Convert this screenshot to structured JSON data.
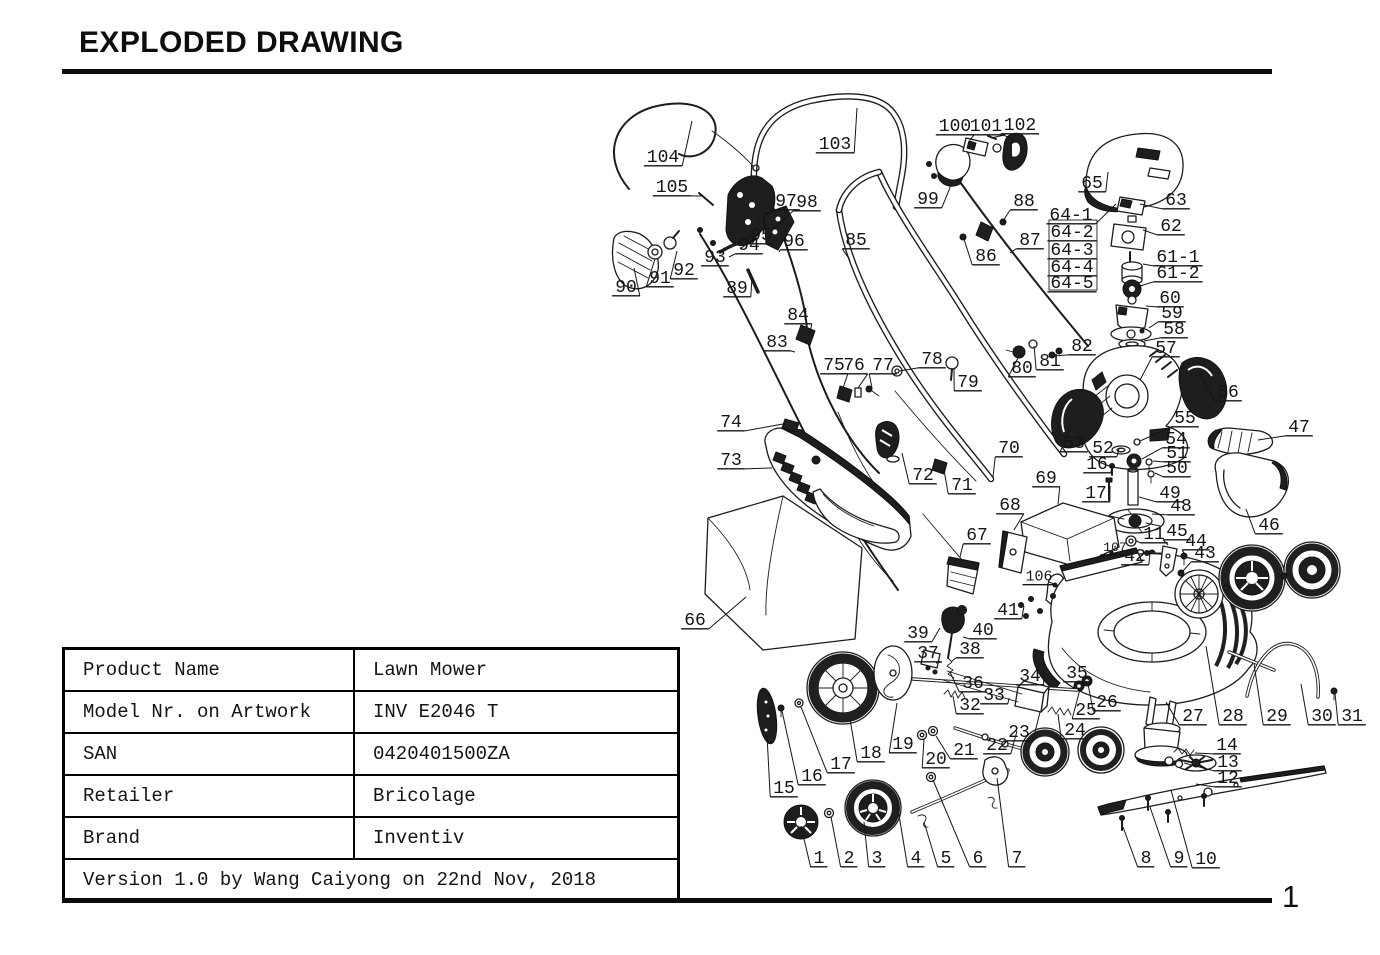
{
  "page": {
    "title": "EXPLODED DRAWING",
    "number": "1"
  },
  "info_table": {
    "rows": [
      {
        "label": "Product Name",
        "value": "Lawn Mower"
      },
      {
        "label": "Model Nr. on Artwork",
        "value": "INV E2046 T"
      },
      {
        "label": "SAN",
        "value": "0420401500ZA"
      },
      {
        "label": "Retailer",
        "value": "Bricolage"
      },
      {
        "label": "Brand",
        "value": "Inventiv"
      }
    ],
    "footer": "Version 1.0 by Wang Caiyong on 22nd Nov, 2018"
  },
  "drawing": {
    "description": "Exploded parts diagram of a lawn mower with numbered part callouts",
    "labels": [
      [
        "104",
        663,
        155,
        692,
        121
      ],
      [
        "105",
        672,
        185,
        703,
        196
      ],
      [
        "103",
        835,
        142,
        857,
        108
      ],
      [
        "100",
        955,
        124,
        970,
        140
      ],
      [
        "101",
        986,
        124,
        991,
        138
      ],
      [
        "102",
        1020,
        123,
        1014,
        140
      ],
      [
        "99",
        928,
        197,
        951,
        185
      ],
      [
        "88",
        1024,
        199,
        1003,
        221
      ],
      [
        "87",
        1030,
        238,
        1010,
        253
      ],
      [
        "86",
        986,
        254,
        964,
        239
      ],
      [
        "85",
        856,
        238,
        850,
        260
      ],
      [
        "65",
        1092,
        181,
        1108,
        172
      ],
      [
        "63",
        1176,
        198,
        1140,
        204
      ],
      [
        "64-1",
        1071,
        213,
        1116,
        204
      ],
      [
        "64-2",
        1072,
        230,
        null,
        null
      ],
      [
        "64-3",
        1072,
        248,
        null,
        null
      ],
      [
        "64-4",
        1072,
        265,
        null,
        null
      ],
      [
        "64-5",
        1072,
        281,
        null,
        null
      ],
      [
        "62",
        1171,
        224,
        1143,
        230
      ],
      [
        "61-1",
        1178,
        255,
        1143,
        264
      ],
      [
        "61-2",
        1178,
        271,
        1137,
        287
      ],
      [
        "60",
        1170,
        296,
        1146,
        306
      ],
      [
        "59",
        1172,
        311,
        1149,
        328
      ],
      [
        "58",
        1174,
        327,
        1144,
        341
      ],
      [
        "97",
        786,
        199,
        757,
        223
      ],
      [
        "98",
        807,
        200,
        770,
        232
      ],
      [
        "96",
        794,
        239,
        779,
        252
      ],
      [
        "95",
        761,
        233,
        740,
        249
      ],
      [
        "94",
        749,
        243,
        729,
        257
      ],
      [
        "93",
        715,
        255,
        703,
        266
      ],
      [
        "92",
        684,
        268,
        677,
        251
      ],
      [
        "91",
        660,
        276,
        655,
        259
      ],
      [
        "90",
        626,
        285,
        634,
        268
      ],
      [
        "89",
        737,
        286,
        752,
        277
      ],
      [
        "84",
        798,
        313,
        810,
        333
      ],
      [
        "83",
        777,
        340,
        795,
        352
      ],
      [
        "82",
        1082,
        344,
        1054,
        356
      ],
      [
        "81",
        1050,
        359,
        1034,
        346
      ],
      [
        "80",
        1022,
        366,
        1020,
        354
      ],
      [
        "57",
        1166,
        346,
        1140,
        380
      ],
      [
        "56",
        1228,
        390,
        1199,
        372
      ],
      [
        "75",
        834,
        363,
        843,
        388
      ],
      [
        "76",
        854,
        363,
        858,
        388
      ],
      [
        "77",
        883,
        363,
        872,
        388
      ],
      [
        "78",
        932,
        357,
        899,
        371
      ],
      [
        "79",
        968,
        380,
        954,
        368
      ],
      [
        "74",
        731,
        420,
        783,
        424
      ],
      [
        "73",
        731,
        458,
        772,
        468
      ],
      [
        "55",
        1185,
        416,
        1140,
        441
      ],
      [
        "54",
        1176,
        437,
        1142,
        459
      ],
      [
        "53",
        1074,
        441,
        1070,
        428
      ],
      [
        "52",
        1103,
        446,
        1119,
        449
      ],
      [
        "51",
        1177,
        451,
        1153,
        461
      ],
      [
        "16",
        1097,
        462,
        1112,
        466
      ],
      [
        "50",
        1177,
        466,
        1155,
        473
      ],
      [
        "70",
        1009,
        446,
        993,
        477
      ],
      [
        "72",
        923,
        473,
        902,
        453
      ],
      [
        "71",
        962,
        483,
        944,
        470
      ],
      [
        "17",
        1096,
        491,
        1110,
        486
      ],
      [
        "49",
        1170,
        491,
        1139,
        497
      ],
      [
        "48",
        1181,
        504,
        1152,
        514
      ],
      [
        "69",
        1046,
        476,
        1058,
        504
      ],
      [
        "68",
        1010,
        503,
        1014,
        530
      ],
      [
        "67",
        977,
        533,
        960,
        557
      ],
      [
        "47",
        1299,
        425,
        1258,
        440
      ],
      [
        "46",
        1269,
        523,
        1246,
        509
      ],
      [
        "66",
        695,
        618,
        746,
        597
      ],
      [
        "11",
        1154,
        532,
        1135,
        540
      ],
      [
        "45",
        1177,
        529,
        1168,
        545
      ],
      [
        "44",
        1196,
        539,
        1185,
        555
      ],
      [
        "43",
        1205,
        551,
        1183,
        571
      ],
      [
        "42",
        1135,
        554,
        1150,
        553
      ],
      [
        "107",
        1115,
        546,
        null,
        null,
        13
      ],
      [
        "106",
        1039,
        575,
        1049,
        582,
        15
      ],
      [
        "41",
        1008,
        608,
        1024,
        606
      ],
      [
        "39",
        918,
        631,
        940,
        628
      ],
      [
        "40",
        983,
        628,
        963,
        637
      ],
      [
        "38",
        970,
        647,
        952,
        661
      ],
      [
        "37",
        928,
        651,
        936,
        663
      ],
      [
        "36",
        973,
        681,
        950,
        672
      ],
      [
        "34",
        1030,
        674,
        1043,
        661
      ],
      [
        "35",
        1077,
        671,
        1077,
        684
      ],
      [
        "33",
        994,
        693,
        1009,
        698
      ],
      [
        "32",
        970,
        703,
        953,
        696
      ],
      [
        "26",
        1107,
        700,
        1088,
        684
      ],
      [
        "25",
        1086,
        708,
        1080,
        689
      ],
      [
        "24",
        1075,
        728,
        1058,
        714
      ],
      [
        "23",
        1019,
        730,
        1040,
        712
      ],
      [
        "22",
        997,
        743,
        1017,
        731
      ],
      [
        "21",
        964,
        748,
        936,
        736
      ],
      [
        "20",
        936,
        757,
        924,
        739
      ],
      [
        "19",
        903,
        742,
        897,
        703
      ],
      [
        "18",
        871,
        751,
        850,
        719
      ],
      [
        "17",
        841,
        762,
        801,
        707
      ],
      [
        "16",
        812,
        774,
        782,
        711
      ],
      [
        "15",
        784,
        786,
        767,
        735
      ],
      [
        "14",
        1227,
        743,
        1195,
        753
      ],
      [
        "13",
        1228,
        760,
        1184,
        763
      ],
      [
        "12",
        1228,
        776,
        1196,
        784
      ],
      [
        "27",
        1193,
        714,
        1166,
        702
      ],
      [
        "28",
        1233,
        714,
        1206,
        646
      ],
      [
        "29",
        1277,
        714,
        1254,
        664
      ],
      [
        "30",
        1322,
        714,
        1301,
        684
      ],
      [
        "31",
        1352,
        714,
        1335,
        693
      ],
      [
        "1",
        819,
        856,
        801,
        826
      ],
      [
        "2",
        849,
        856,
        831,
        817
      ],
      [
        "3",
        877,
        856,
        864,
        822
      ],
      [
        "4",
        916,
        856,
        897,
        803
      ],
      [
        "5",
        946,
        856,
        924,
        822
      ],
      [
        "6",
        978,
        856,
        933,
        780
      ],
      [
        "7",
        1017,
        856,
        997,
        778
      ],
      [
        "8",
        1146,
        856,
        1123,
        827
      ],
      [
        "9",
        1179,
        856,
        1150,
        807
      ],
      [
        "10",
        1206,
        857,
        1171,
        790
      ]
    ]
  }
}
